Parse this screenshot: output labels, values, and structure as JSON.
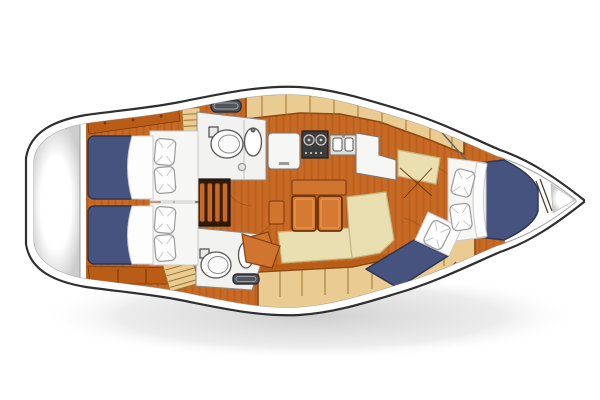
{
  "diagram": {
    "type": "floor-plan",
    "subject": "sailing-yacht-interior-layout",
    "view": "top-down",
    "orientation": "bow-right-stern-left",
    "rooms": [
      {
        "id": "stern-platform",
        "label": "stern transom platform"
      },
      {
        "id": "aft-cabin-upper",
        "label": "aft double cabin (upper)",
        "furniture": [
          "double-berth",
          "2-pillows",
          "hull-shelf",
          "louvered-locker"
        ]
      },
      {
        "id": "aft-cabin-lower",
        "label": "aft double cabin (lower)",
        "furniture": [
          "double-berth",
          "2-pillows",
          "drawer-shelf",
          "louvered-locker"
        ]
      },
      {
        "id": "companionway",
        "label": "companionway",
        "furniture": [
          "4-tread-steps",
          "engine-compartment"
        ]
      },
      {
        "id": "head-upper",
        "label": "head / wet room (upper)",
        "furniture": [
          "toilet",
          "washbasin",
          "shower-drain",
          "deck-hatch"
        ]
      },
      {
        "id": "galley",
        "label": "galley",
        "furniture": [
          "refrigerator-top",
          "2-burner-stove",
          "double-sink",
          "l-shaped-counter",
          "overhead-lockers"
        ]
      },
      {
        "id": "saloon",
        "label": "saloon",
        "furniture": [
          "folding-table-2-leaves",
          "l-shaped-settee",
          "sideboard",
          "seat"
        ]
      },
      {
        "id": "head-lower",
        "label": "head / wet room (lower)",
        "furniture": [
          "toilet",
          "washbasin",
          "deck-hatch",
          "angled-door-panel"
        ]
      },
      {
        "id": "wardrobe-nav",
        "label": "wardrobe / chart area",
        "furniture": [
          "chart-seat",
          "hanging-locker-doors"
        ]
      },
      {
        "id": "forward-cabin",
        "label": "forward cabin",
        "furniture": [
          "v-berth-double",
          "2-pillows",
          "angled-single-berth",
          "1-pillow"
        ]
      },
      {
        "id": "bow-locker",
        "label": "bow anchor locker"
      }
    ]
  },
  "colors": {
    "background": "#ffffff",
    "hull_outline": "#2f2f2f",
    "deck_line": "#a8a8a8",
    "shadow": "#9b9b9b",
    "floor_wood": "#c96a24",
    "wood_trim_dark": "#8a4a10",
    "wood_shelf": "#b85c16",
    "berth_blue": "#46537e",
    "berth_blue_edge": "#2c3756",
    "linen_white": "#fdfdfd",
    "linen_outline": "#9a9a9a",
    "locker_tan": "#eacb92",
    "locker_stripe": "#9a7434",
    "settee_beige": "#eadfb0",
    "settee_edge": "#c2b581",
    "counter_white": "#f6f6f4",
    "room_white": "#f2f2f0",
    "fixture_outline": "#555555",
    "appliance_dark": "#3c3c3c",
    "hatch_gray": "#4f555b",
    "table_orange": "#d57a33",
    "bench_orange": "#d0752f"
  }
}
